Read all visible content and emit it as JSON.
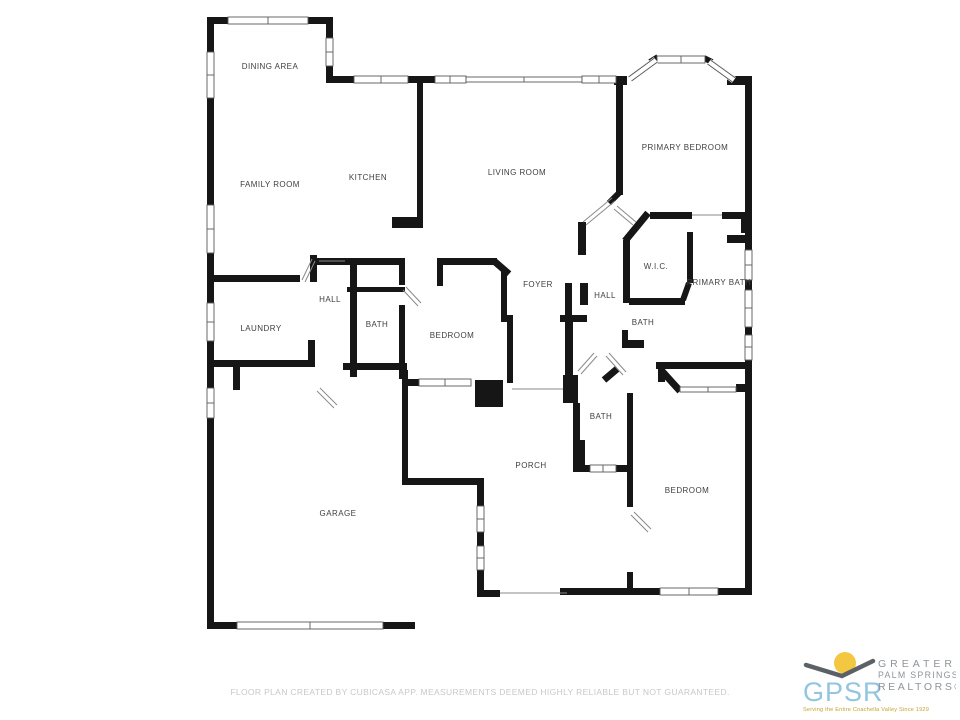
{
  "floor_plan": {
    "rooms": [
      {
        "id": "dining-area",
        "label": "DINING AREA",
        "x": 270,
        "y": 69
      },
      {
        "id": "family-room",
        "label": "FAMILY ROOM",
        "x": 270,
        "y": 187
      },
      {
        "id": "kitchen",
        "label": "KITCHEN",
        "x": 368,
        "y": 180
      },
      {
        "id": "living-room",
        "label": "LIVING ROOM",
        "x": 517,
        "y": 175
      },
      {
        "id": "primary-bedroom",
        "label": "PRIMARY BEDROOM",
        "x": 685,
        "y": 150
      },
      {
        "id": "wic",
        "label": "W.I.C.",
        "x": 656,
        "y": 269
      },
      {
        "id": "primary-bath",
        "label": "PRIMARY BATH",
        "x": 719,
        "y": 285
      },
      {
        "id": "hall-right",
        "label": "HALL",
        "x": 605,
        "y": 298
      },
      {
        "id": "foyer",
        "label": "FOYER",
        "x": 538,
        "y": 287
      },
      {
        "id": "hall-left",
        "label": "HALL",
        "x": 330,
        "y": 302
      },
      {
        "id": "laundry",
        "label": "LAUNDRY",
        "x": 261,
        "y": 331
      },
      {
        "id": "bath-center",
        "label": "BATH",
        "x": 377,
        "y": 327
      },
      {
        "id": "bedroom-center",
        "label": "BEDROOM",
        "x": 452,
        "y": 338
      },
      {
        "id": "bath-right",
        "label": "BATH",
        "x": 643,
        "y": 325
      },
      {
        "id": "bath-bottom",
        "label": "BATH",
        "x": 601,
        "y": 419
      },
      {
        "id": "porch",
        "label": "PORCH",
        "x": 531,
        "y": 468
      },
      {
        "id": "garage",
        "label": "GARAGE",
        "x": 338,
        "y": 516
      },
      {
        "id": "bedroom-bottom",
        "label": "BEDROOM",
        "x": 687,
        "y": 493
      }
    ],
    "footer_note": "FLOOR PLAN CREATED BY CUBICASA APP. MEASUREMENTS DEEMED HIGHLY RELIABLE BUT NOT GUARANTEED."
  },
  "logo": {
    "acronym": "GPSR",
    "name_line1": "GREATER",
    "name_line2": "PALM SPRINGS",
    "name_line3": "REALTORS®",
    "tagline": "Serving the Entire Coachella Valley Since 1929",
    "colors": {
      "acronym_blue": "#92c5df",
      "sun_yellow": "#f3c73f",
      "bird_gray": "#5b6167",
      "name_gray": "#8e9499",
      "tagline_gold": "#c7a229"
    }
  },
  "plan_colors": {
    "wall": "#161616",
    "label_text": "#3f3f3f",
    "thin_line": "#8a8a8a",
    "footer_text": "#c8c8c8"
  }
}
